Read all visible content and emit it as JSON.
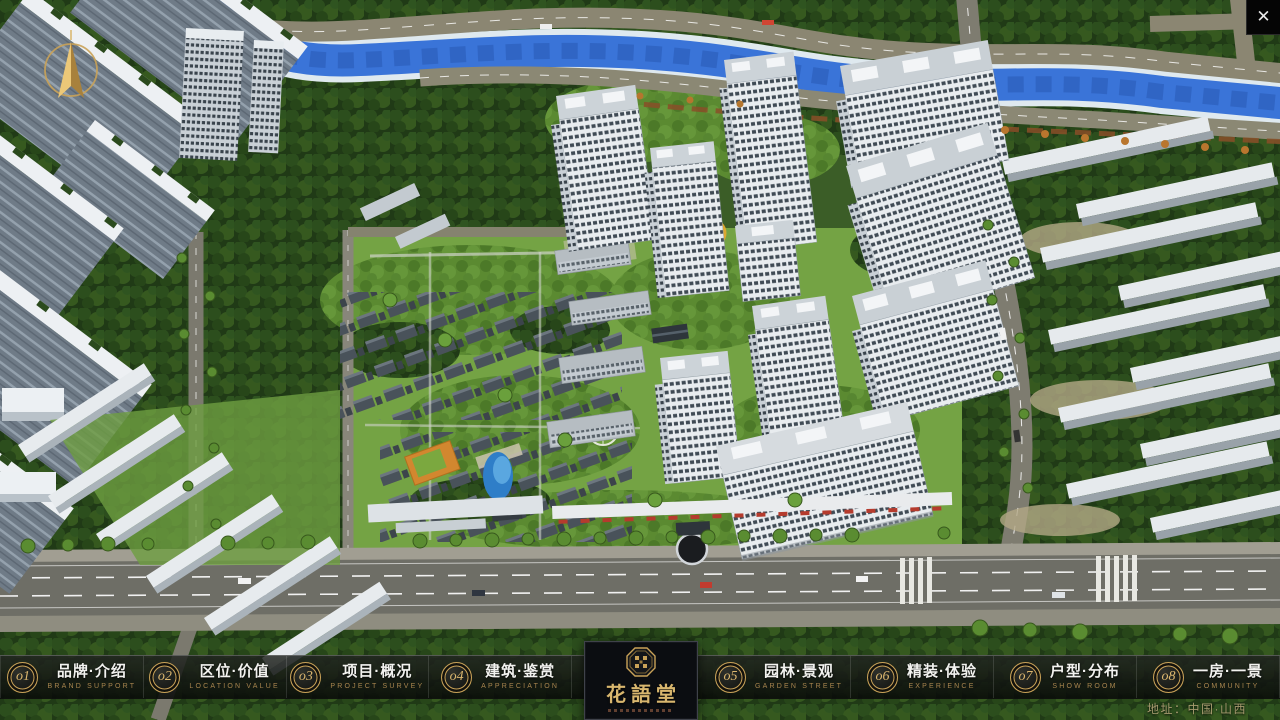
{
  "window_controls": {
    "close_glyph": "✕"
  },
  "nav": {
    "items": [
      {
        "num": "o1",
        "label": "品牌·介绍",
        "sub": "BRAND SUPPORT"
      },
      {
        "num": "o2",
        "label": "区位·价值",
        "sub": "LOCATION VALUE"
      },
      {
        "num": "o3",
        "label": "项目·概况",
        "sub": "PROJECT SURVEY"
      },
      {
        "num": "o4",
        "label": "建筑·鉴赏",
        "sub": "APPRECIATION"
      },
      {
        "num": "o5",
        "label": "园林·景观",
        "sub": "GARDEN STREET"
      },
      {
        "num": "o6",
        "label": "精装·体验",
        "sub": "EXPERIENCE"
      },
      {
        "num": "o7",
        "label": "户型·分布",
        "sub": "SHOW ROOM"
      },
      {
        "num": "o8",
        "label": "一房·一景",
        "sub": "COMMUNITY"
      }
    ]
  },
  "logo": {
    "name": "花語堂"
  },
  "footer": {
    "address": "地址：中国·山西"
  },
  "colors": {
    "accent_gold": "#c9a258",
    "nav_text": "#f2f2ef",
    "nav_sub": "#a8854e",
    "address_text": "#a59a6e",
    "river_blue": "#3a74d8"
  }
}
